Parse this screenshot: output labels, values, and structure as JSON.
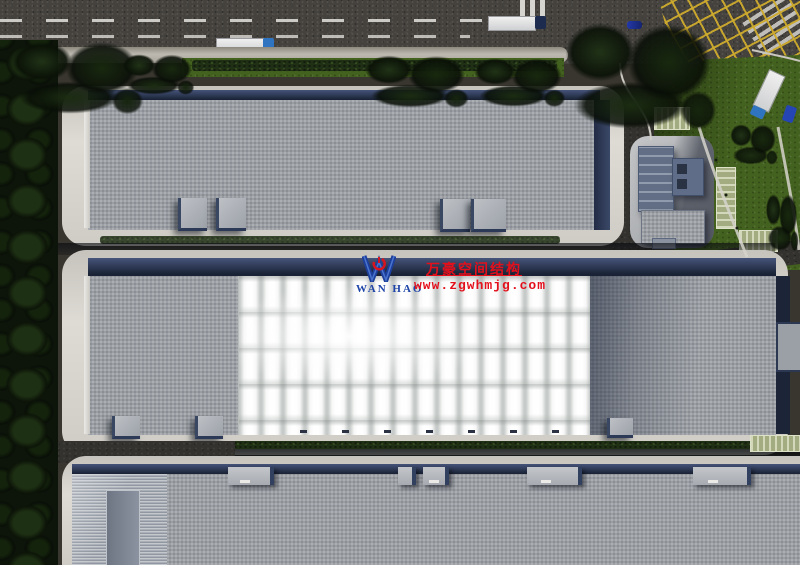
{
  "watermark": {
    "brand": "WAN HAO",
    "company_cn": "万豪空间结构",
    "website": "www.zgwhmjg.com",
    "brand_color": "#1e44a8",
    "accent_color": "#e3101c"
  },
  "palette": {
    "asphalt": "#45423e",
    "roof_gray": "#9ea2a7",
    "membrane_white": "#f6f7f6",
    "apron_concrete": "#d8d5cf",
    "facade_navy": "#232d47",
    "grass": "#44621f",
    "trees": "#16240f",
    "hedge": "#203015",
    "road_marking_white": "#e4e2dc",
    "road_marking_yellow": "#cdaa2d",
    "truck_cab_blue": "#2f74c0",
    "car_blue": "#2338a8"
  }
}
